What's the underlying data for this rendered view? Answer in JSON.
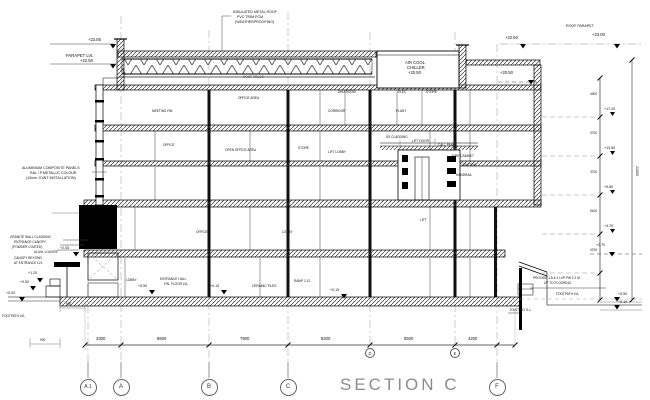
{
  "title": "SECTION C",
  "grid": {
    "bubbles": [
      "A.1",
      "A",
      "B",
      "C",
      "F"
    ],
    "inline_bubbles": [
      "D",
      "E"
    ]
  },
  "dims": {
    "bottom": [
      "3300",
      "8800",
      "7900",
      "8200",
      "8500",
      "4200"
    ],
    "left": [
      "500",
      "900"
    ],
    "right": [
      "4300",
      "3700",
      "3700",
      "5100",
      "4700"
    ],
    "right_overall": "21500"
  },
  "levels": {
    "top_left": "+23.85",
    "parapet_label": "PARAPET LVL",
    "parapet_value": "+22.50",
    "top_right": "+22.50",
    "roof_parapet_label": "ROOF PARAPET",
    "roof_parapet_value": "+23.00",
    "chiller_deck": "+20.50",
    "chain": [
      "+17.20",
      "+13.50",
      "+9.80",
      "+4.70"
    ],
    "canopy": "+2.05",
    "entry": "+1.20",
    "entry_step": "+0.50",
    "ground_zero": "+0.00",
    "lobby": "+0.50",
    "hall": "+0.15",
    "ramp": "+0.10",
    "right_upper": "+2.70",
    "right_a": "+0.50",
    "right_b": "+0.10"
  },
  "notes": {
    "roof": [
      "INSULATED METAL ROOF",
      "PVC TRIM PCM",
      "(WEATHERPROOFING)"
    ],
    "truss": "ROOF TRUSS",
    "chiller": [
      "AIR COOL",
      "CHILLER",
      "+20.50"
    ],
    "panels": [
      "ALUMINIUM COMPOSITE PANELS",
      "RAL / P.METALLIC COLOUR",
      "(10mm JOINT INSTALLATION)"
    ],
    "entrance": [
      "GRANITE WALL CLADDING",
      "ENTRANCE CANOPY",
      "(POWDER COATED)",
      "ALUM. LOUVRE",
      "CANOPY BEYOND",
      "AT ENTRANCE LVL",
      "FOOTPATH LVL"
    ],
    "provide": [
      "PROVIDE 1.8 & 2 LVP PW 2.2 M.",
      "UP TO FLOORING"
    ],
    "existing_gl": "EXISTING G.L.",
    "footpath_right": "FOOTPATH LVL",
    "cluster": [
      "SS CLADDING",
      "LIFT DOOR",
      "CALL PANEL",
      "FIRE CABINET",
      "SKIRTING",
      "HANDRAIL"
    ]
  },
  "rooms": [
    "OFFICE AREA",
    "AHU ROOM",
    "ELEC",
    "STORE",
    "MEETING RM",
    "CORRIDOR",
    "PLANT",
    "OFFICE",
    "OPEN OFFICE AREA",
    "STORE",
    "LIFT LOBBY",
    "OFFICE",
    "LOBBY",
    "LIFT",
    "LOBBY",
    "ENTRANCE HALL",
    "FIN. FLOOR LVL",
    "CERAMIC TILES",
    "RAMP 1:12"
  ]
}
